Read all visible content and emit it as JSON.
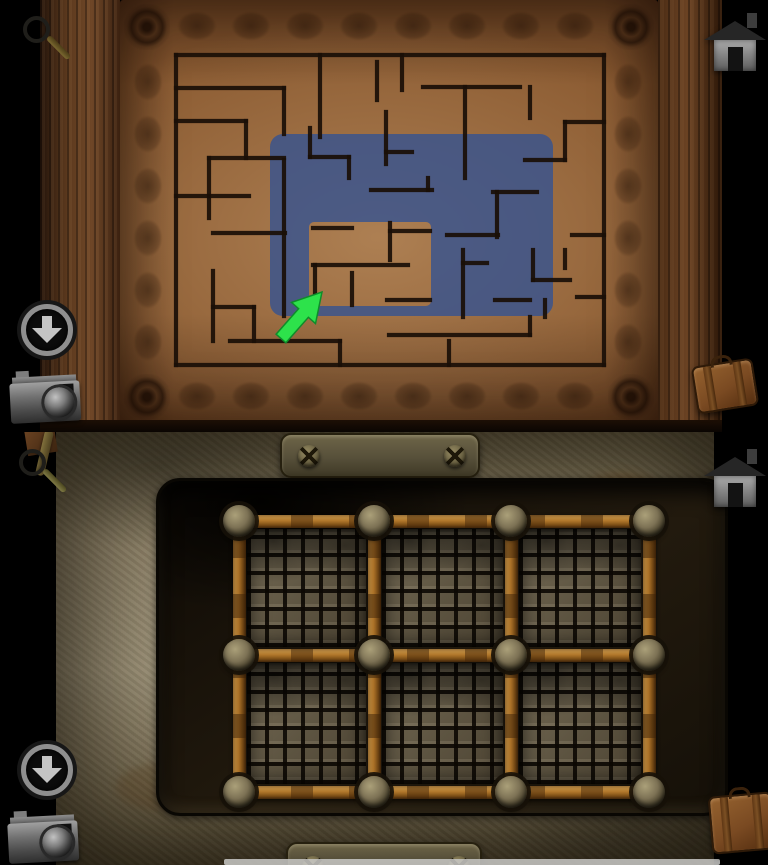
{
  "scene": {
    "description": "two stacked game screenshots: carved wooden maze door (top) and rusted metal grate wall (bottom)",
    "colors": {
      "background": "#000000",
      "wood_board": "#8a5a31",
      "maze_line": "#1a0f07",
      "highlight_blue": "rgba(52,82,145,0.8)",
      "arrow_green": "#2de24b",
      "arrow_outline": "#0f8c2a",
      "stone_wall": "#8e8268",
      "bar_rust": "#b0762a",
      "bolt_metal": "#7d7255",
      "icon_gray": "#c4c4c4"
    }
  },
  "top_scene": {
    "label": "wooden maze panel with highlighted path hint",
    "maze": {
      "line_width": 4.2,
      "segments": [
        [
          176,
          55,
          604,
          55
        ],
        [
          176,
          55,
          176,
          365
        ],
        [
          604,
          55,
          604,
          365
        ],
        [
          176,
          365,
          604,
          365
        ],
        [
          176,
          88,
          284,
          88
        ],
        [
          284,
          88,
          284,
          134
        ],
        [
          176,
          121,
          246,
          121
        ],
        [
          246,
          121,
          246,
          158
        ],
        [
          209,
          158,
          284,
          158
        ],
        [
          209,
          158,
          209,
          218
        ],
        [
          176,
          196,
          249,
          196
        ],
        [
          213,
          233,
          285,
          233
        ],
        [
          284,
          160,
          284,
          316
        ],
        [
          320,
          55,
          320,
          137
        ],
        [
          310,
          128,
          310,
          157
        ],
        [
          310,
          157,
          349,
          157
        ],
        [
          349,
          157,
          349,
          178
        ],
        [
          377,
          62,
          377,
          100
        ],
        [
          402,
          55,
          402,
          90
        ],
        [
          386,
          112,
          386,
          164
        ],
        [
          386,
          152,
          412,
          152
        ],
        [
          371,
          190,
          432,
          190
        ],
        [
          428,
          178,
          428,
          190
        ],
        [
          313,
          228,
          352,
          228
        ],
        [
          390,
          223,
          390,
          260
        ],
        [
          390,
          231,
          430,
          231
        ],
        [
          313,
          265,
          408,
          265
        ],
        [
          315,
          265,
          315,
          303
        ],
        [
          352,
          273,
          352,
          305
        ],
        [
          387,
          300,
          430,
          300
        ],
        [
          423,
          87,
          520,
          87
        ],
        [
          465,
          87,
          465,
          178
        ],
        [
          530,
          87,
          530,
          118
        ],
        [
          565,
          122,
          604,
          122
        ],
        [
          565,
          122,
          565,
          160
        ],
        [
          525,
          160,
          565,
          160
        ],
        [
          493,
          192,
          537,
          192
        ],
        [
          497,
          192,
          497,
          237
        ],
        [
          447,
          235,
          498,
          235
        ],
        [
          463,
          250,
          463,
          317
        ],
        [
          463,
          263,
          487,
          263
        ],
        [
          533,
          250,
          533,
          280
        ],
        [
          533,
          280,
          570,
          280
        ],
        [
          545,
          300,
          545,
          317
        ],
        [
          495,
          300,
          530,
          300
        ],
        [
          572,
          235,
          604,
          235
        ],
        [
          577,
          297,
          604,
          297
        ],
        [
          213,
          271,
          213,
          341
        ],
        [
          213,
          307,
          254,
          307
        ],
        [
          254,
          307,
          254,
          341
        ],
        [
          230,
          341,
          340,
          341
        ],
        [
          340,
          341,
          340,
          365
        ],
        [
          389,
          335,
          530,
          335
        ],
        [
          530,
          317,
          530,
          335
        ],
        [
          449,
          341,
          449,
          365
        ],
        [
          565,
          250,
          565,
          268
        ]
      ]
    },
    "highlight": {
      "outer": [
        270,
        134,
        283,
        182,
        13
      ],
      "hole": [
        309,
        222,
        122,
        84,
        5
      ],
      "color": "rgba(52,82,145,0.8)"
    },
    "arrow": {
      "points": "322,292 315.5,323.6 308.4,317.3 285.9,342.8 276.1,334.2 298.6,308.7 291.5,302.4",
      "fill": "#2de24b",
      "stroke": "#0f8c2a"
    },
    "icons": [
      "magnifier-icon",
      "home-icon",
      "download-icon",
      "camera-icon",
      "suitcase-icon"
    ]
  },
  "bottom_scene": {
    "label": "stone wall with 2x3 rusted mesh grate",
    "grid": {
      "rows": 2,
      "cols": 3,
      "bar_centers_x": [
        80,
        215,
        352,
        490
      ],
      "bar_centers_y": [
        40,
        174,
        311
      ],
      "bar_thickness": 13,
      "bolt_diameter": 32
    },
    "plates": {
      "top_screws": 2,
      "bottom_screws": 2
    },
    "icons": [
      "magnifier-icon",
      "home-icon",
      "download-icon",
      "camera-icon",
      "suitcase-icon"
    ]
  }
}
